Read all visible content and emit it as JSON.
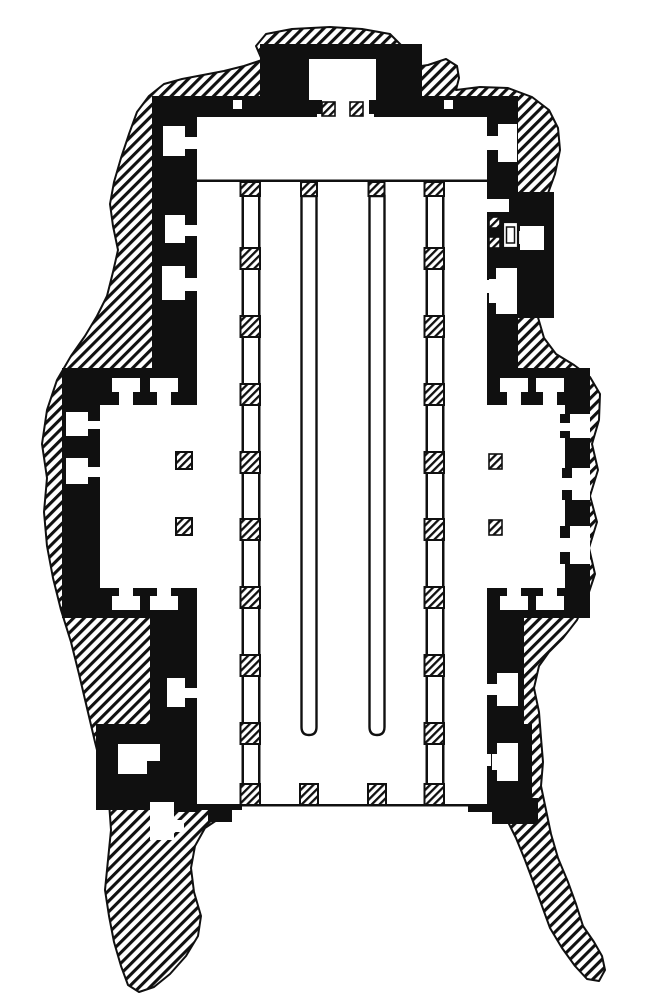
{
  "figure": {
    "title": "Ground plan of a rock-cut temple",
    "type": "architectural floor plan engraving",
    "technique": "black ink line drawing; diagonal hatching marks solid rock, hatched squares mark pillars cut in section, white areas are excavated interior space",
    "aria_label": "Black and white engraved ground plan of a rock-hewn temple surrounded by hatched rock, with a pillared sanctuary at top, a long colonnaded nave with two screen walls, side chapels left and right, and an open forecourt between two rock spurs at the bottom",
    "ink_color": "#101010",
    "paper_color": "#ffffff"
  },
  "legend": {
    "hatched_area": "solid rock mass (in section)",
    "solid_black": "rock-cut masonry walls",
    "white_area": "excavated interior space",
    "hatched_square": "pillar (in section)"
  },
  "elements": {
    "sanctuary": "projecting shrine chamber at top with two pillars in antis",
    "transverse_hall": "wide hall across the head of the nave",
    "nave": "long hall with two lateral colonnades and two long parallel screen walls",
    "left_chapel": "side chapel with two T-shaped doorways, two outer wall niches and two pillars",
    "right_chapel": "side chapel with two T-shaped doorways, three outer wall niches and two pillars",
    "right_shrine_annex": "lateral cell group with altar block and two small pillars",
    "wall_niches": "keyhole niches along the nave side walls",
    "forecourt": "open court at the bottom flanked by two trailing rock spurs"
  },
  "counts": {
    "colonnade_rows": 2,
    "pillars_per_colonnade": 10,
    "screen_walls": 2,
    "sanctuary_pillars": 2,
    "side_chapels": 2
  }
}
